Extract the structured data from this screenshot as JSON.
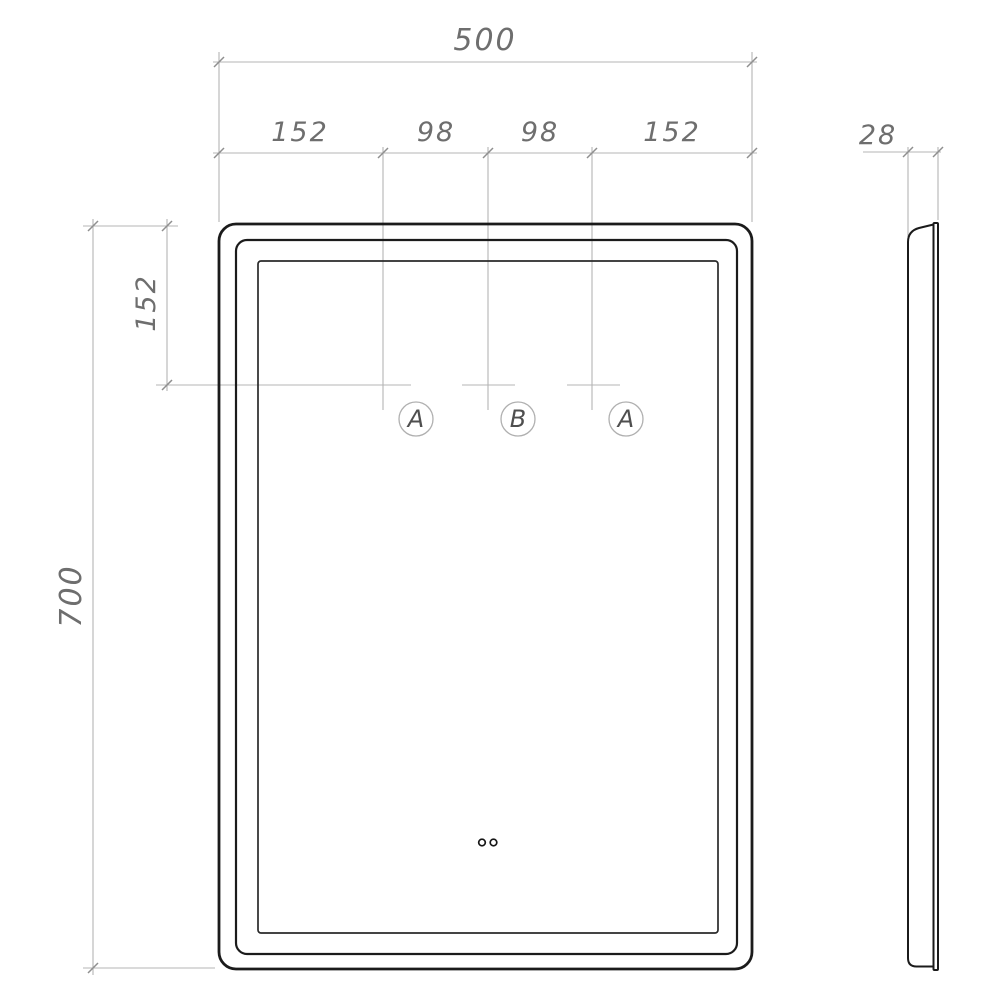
{
  "drawing": {
    "front_view": {
      "dim_total_width": "500",
      "dim_segments": [
        "152",
        "98",
        "98",
        "152"
      ],
      "dim_top_offset": "152",
      "dim_total_height": "700",
      "sensor_labels": [
        "A",
        "B",
        "A"
      ]
    },
    "side_view": {
      "dim_depth": "28"
    },
    "icons": {
      "touch_dots": "two-small-rings"
    },
    "colors": {
      "outline": "#1b1b1b",
      "dimension_line": "#b4b4b4",
      "dimension_text": "#6e6e6e",
      "callout_text": "#4f4f4f"
    }
  }
}
